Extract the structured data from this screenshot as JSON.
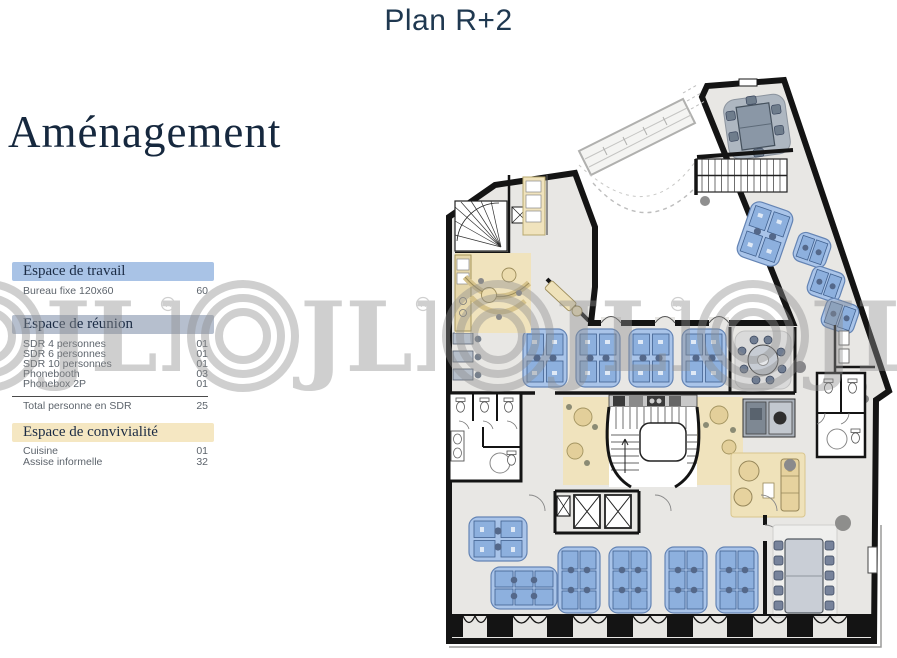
{
  "page": {
    "title": "Plan R+2",
    "heading": "Aménagement"
  },
  "watermark": {
    "text": "JLL",
    "registered": "R"
  },
  "legend": {
    "sections": [
      {
        "title": "Espace de travail",
        "color": "#a9c3e6",
        "items": [
          {
            "label": "Bureau fixe 120x60",
            "value": "60"
          }
        ]
      },
      {
        "title": "Espace de réunion",
        "color": "#b6bfce",
        "items": [
          {
            "label": "SDR 4 personnes",
            "value": "01"
          },
          {
            "label": "SDR 6 personnes",
            "value": "01"
          },
          {
            "label": "SDR 10 personnes",
            "value": "01"
          },
          {
            "label": "Phonebooth",
            "value": "03"
          },
          {
            "label": "Phonebox 2P",
            "value": "01"
          }
        ],
        "total": {
          "label": "Total personne en SDR",
          "value": "25"
        }
      },
      {
        "title": "Espace de convivialité",
        "color": "#f5e7c2",
        "items": [
          {
            "label": "Cuisine",
            "value": "01"
          },
          {
            "label": "Assise informelle",
            "value": "32"
          }
        ]
      }
    ]
  },
  "plan_colors": {
    "floor": "#e8e7e4",
    "walls": "#141414",
    "workstation": "#a9c4e9",
    "meeting_furniture": "#76839b",
    "conviviality": "#f0e3bd"
  }
}
